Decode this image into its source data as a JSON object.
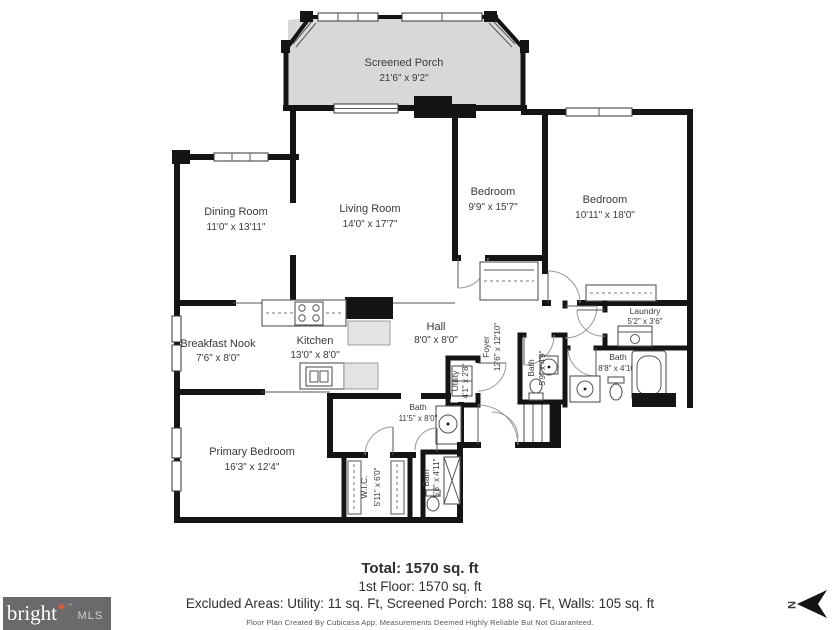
{
  "plan": {
    "rooms": {
      "porch": {
        "name": "Screened Porch",
        "dims": "21'6\" x 9'2\""
      },
      "dining": {
        "name": "Dining Room",
        "dims": "11'0\" x 13'11\""
      },
      "living": {
        "name": "Living Room",
        "dims": "14'0\" x 17'7\""
      },
      "bedroom1": {
        "name": "Bedroom",
        "dims": "9'9\" x 15'7\""
      },
      "bedroom2": {
        "name": "Bedroom",
        "dims": "10'11\" x 18'0\""
      },
      "nook": {
        "name": "Breakfast Nook",
        "dims": "7'6\" x 8'0\""
      },
      "kitchen": {
        "name": "Kitchen",
        "dims": "13'0\" x 8'0\""
      },
      "hall": {
        "name": "Hall",
        "dims": "8'0\" x 8'0\""
      },
      "foyer": {
        "name": "Foyer",
        "dims": "12'6\" x 12'10\""
      },
      "utility": {
        "name": "Utility",
        "dims": "4'1\" x 2'8\""
      },
      "laundry": {
        "name": "Laundry",
        "dims": "5'2\" x 3'6\""
      },
      "bath_hall": {
        "name": "Bath",
        "dims": "8'8\" x 4'10\""
      },
      "bath_foyer": {
        "name": "Bath",
        "dims": "5'9\" x 4'9\""
      },
      "bath_primary": {
        "name": "Bath",
        "dims": "11'5\" x 8'0\""
      },
      "primary": {
        "name": "Primary Bedroom",
        "dims": "16'3\" x 12'4\""
      },
      "wic": {
        "name": "W.I.C.",
        "dims": "5'11\" x 6'0\""
      },
      "bath_shower": {
        "name": "Bath",
        "dims": "5'8\" x 4'11\""
      }
    }
  },
  "summary": {
    "total": "Total: 1570 sq. ft",
    "first_floor": "1st Floor: 1570 sq. ft",
    "excluded": "Excluded Areas: Utility: 11 sq. Ft, Screened Porch: 188 sq. Ft, Walls: 105 sq. ft",
    "disclaimer": "Floor Plan Created By Cubicasa App. Measurements Deemed Highly Reliable But Not Guaranteed."
  },
  "branding": {
    "name": "bright",
    "mark": "✱",
    "tm": "™",
    "suffix": "MLS"
  },
  "compass": {
    "label": "N"
  },
  "colors": {
    "wall": "#141414",
    "porch_fill": "#d8d8d8",
    "logo_bg": "#6a6a6d",
    "accent": "#e05b35"
  }
}
